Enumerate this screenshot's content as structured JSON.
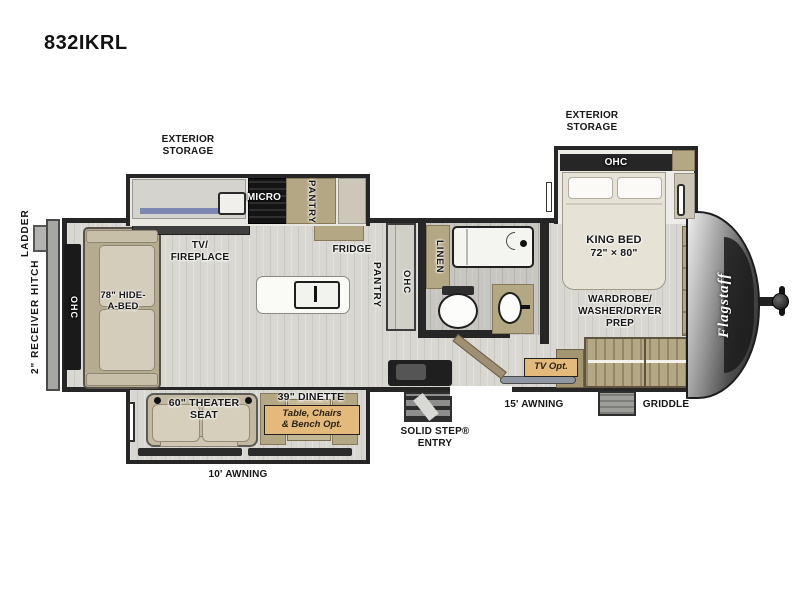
{
  "title": "832IKRL",
  "brand": "Flagstaff",
  "colors": {
    "wall": "#262626",
    "floor": "#d8d7d1",
    "cabinet_tan": "#b4a783",
    "sofa_beige": "#c3b9a2",
    "badge_bg": "#e3ba7b",
    "counter_blue": "#7d87b2",
    "front_cap": "#3c3c3c"
  },
  "labels": {
    "ladder": "LADDER",
    "receiver_hitch": "2\" RECEIVER HITCH",
    "ohc_rear": "OHC",
    "hide_a_bed": [
      "78\" HIDE-",
      "A-BED"
    ],
    "exterior_storage_left": [
      "EXTERIOR",
      "STORAGE"
    ],
    "tv_fireplace": [
      "TV/",
      "FIREPLACE"
    ],
    "micro": "MICRO",
    "pantry_slide": "PANTRY",
    "fridge": "FRIDGE",
    "pantry_island": "PANTRY",
    "ohc_cabinet": "OHC",
    "linen": "LINEN",
    "exterior_storage_right": [
      "EXTERIOR",
      "STORAGE"
    ],
    "ohc_bedroom": "OHC",
    "king_bed": [
      "KING BED",
      "72\" × 80\""
    ],
    "wardrobe": [
      "WARDROBE/",
      "WASHER/DRYER",
      "PREP"
    ],
    "tv_opt": "TV Opt.",
    "griddle": "GRIDDLE",
    "awning_15": "15' AWNING",
    "solid_step": [
      "SOLID STEP®",
      "ENTRY"
    ],
    "awning_10": "10' AWNING",
    "theater_seat": [
      "60\" THEATER",
      "SEAT"
    ],
    "dinette": "39\" DINETTE",
    "dinette_opt": [
      "Table, Chairs",
      "& Bench Opt."
    ]
  }
}
